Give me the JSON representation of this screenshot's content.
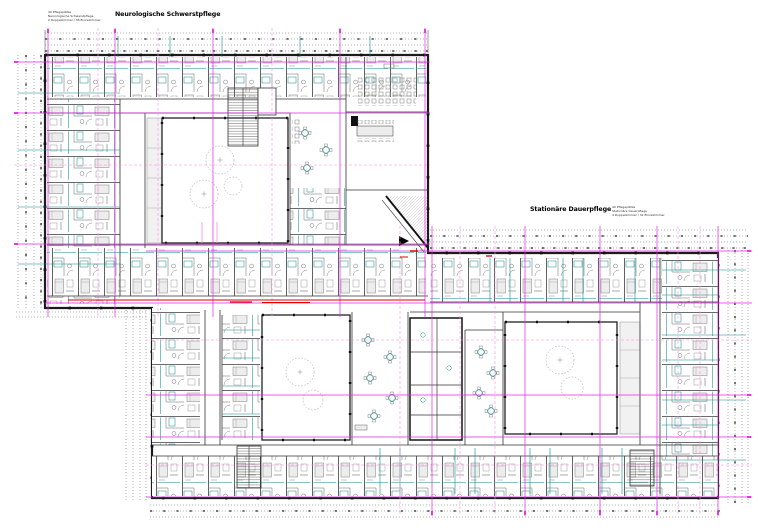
{
  "document": {
    "kind": "architectural floor plan (CAD sheet)",
    "sheet_background": "#ffffff"
  },
  "labels": {
    "wing1": {
      "title": "Neurologische Schwerstpflege",
      "notes": [
        "40 Pflegeplätze",
        "Neurologische Schwerstpflege",
        "2 Doppelzimmer / 36 Einzelzimmer"
      ]
    },
    "wing2": {
      "title": "Stationäre Dauerpflege",
      "notes": [
        "40 Pflegeplätze",
        "Stationäre Dauerpflege",
        "4 Doppelzimmer / 32 Einzelzimmer"
      ]
    }
  },
  "legend_colors": {
    "grid_axis_magenta": "#e922e9",
    "grid_axis_light_pink": "#ff8ae4",
    "walls_black": "#1b1b1b",
    "furniture_teal": "#0e8c8c",
    "fire_line_red": "#e00000",
    "dimension_gray": "#3c3c3c"
  },
  "plan_features": {
    "wings": [
      {
        "name": "Neurologische Schwerstpflege",
        "position": "upper-left",
        "courtyards": 1
      },
      {
        "name": "Stationäre Dauerpflege",
        "position": "lower-right",
        "courtyards": 2
      }
    ],
    "courtyard_trees_dashed_circles": true,
    "patient_rooms_on_perimeter": true
  }
}
